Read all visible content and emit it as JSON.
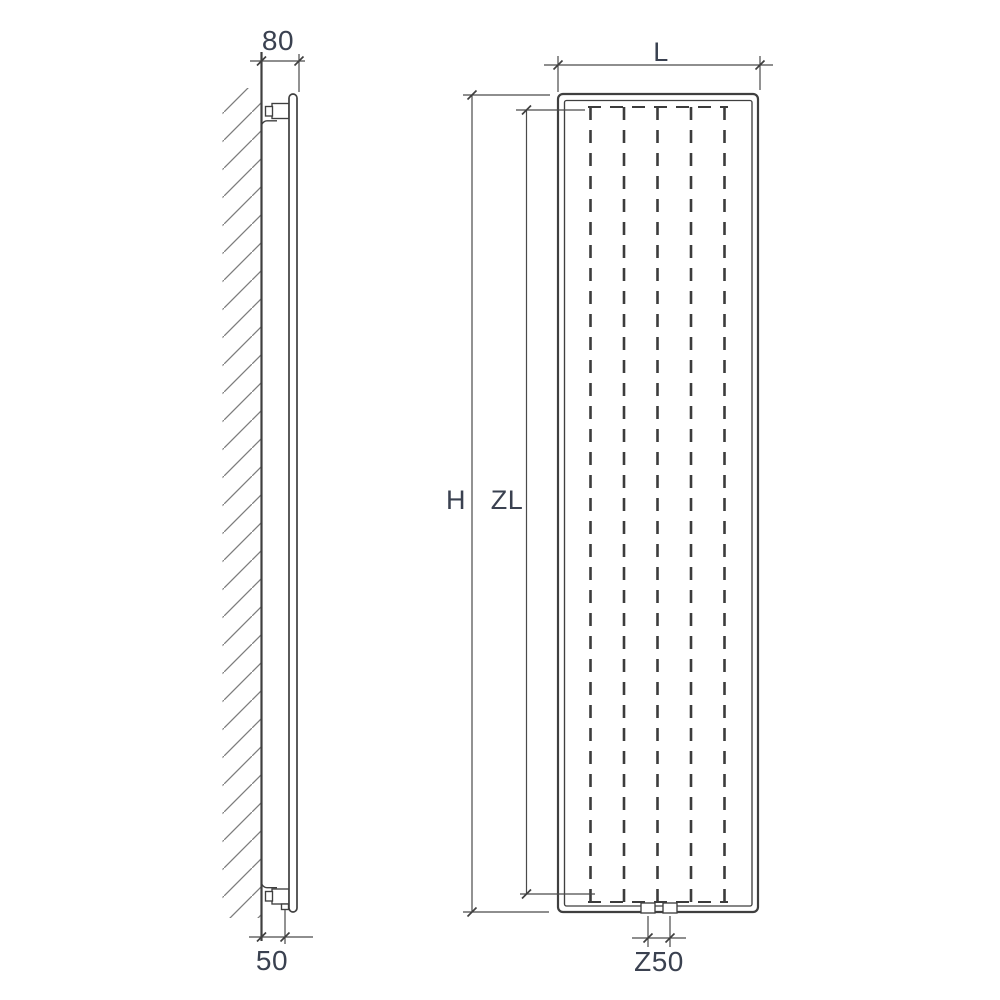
{
  "drawing": {
    "background": "#ffffff",
    "line_color": "#3f3f3f",
    "label_color": "#3a4150",
    "side_view": {
      "labels": {
        "wall_clearance_top": "80",
        "wall_clearance_bottom": "50"
      }
    },
    "front_view": {
      "labels": {
        "length": "L",
        "height": "H",
        "heated_length": "ZL",
        "connection_spacing": "Z50"
      }
    }
  }
}
